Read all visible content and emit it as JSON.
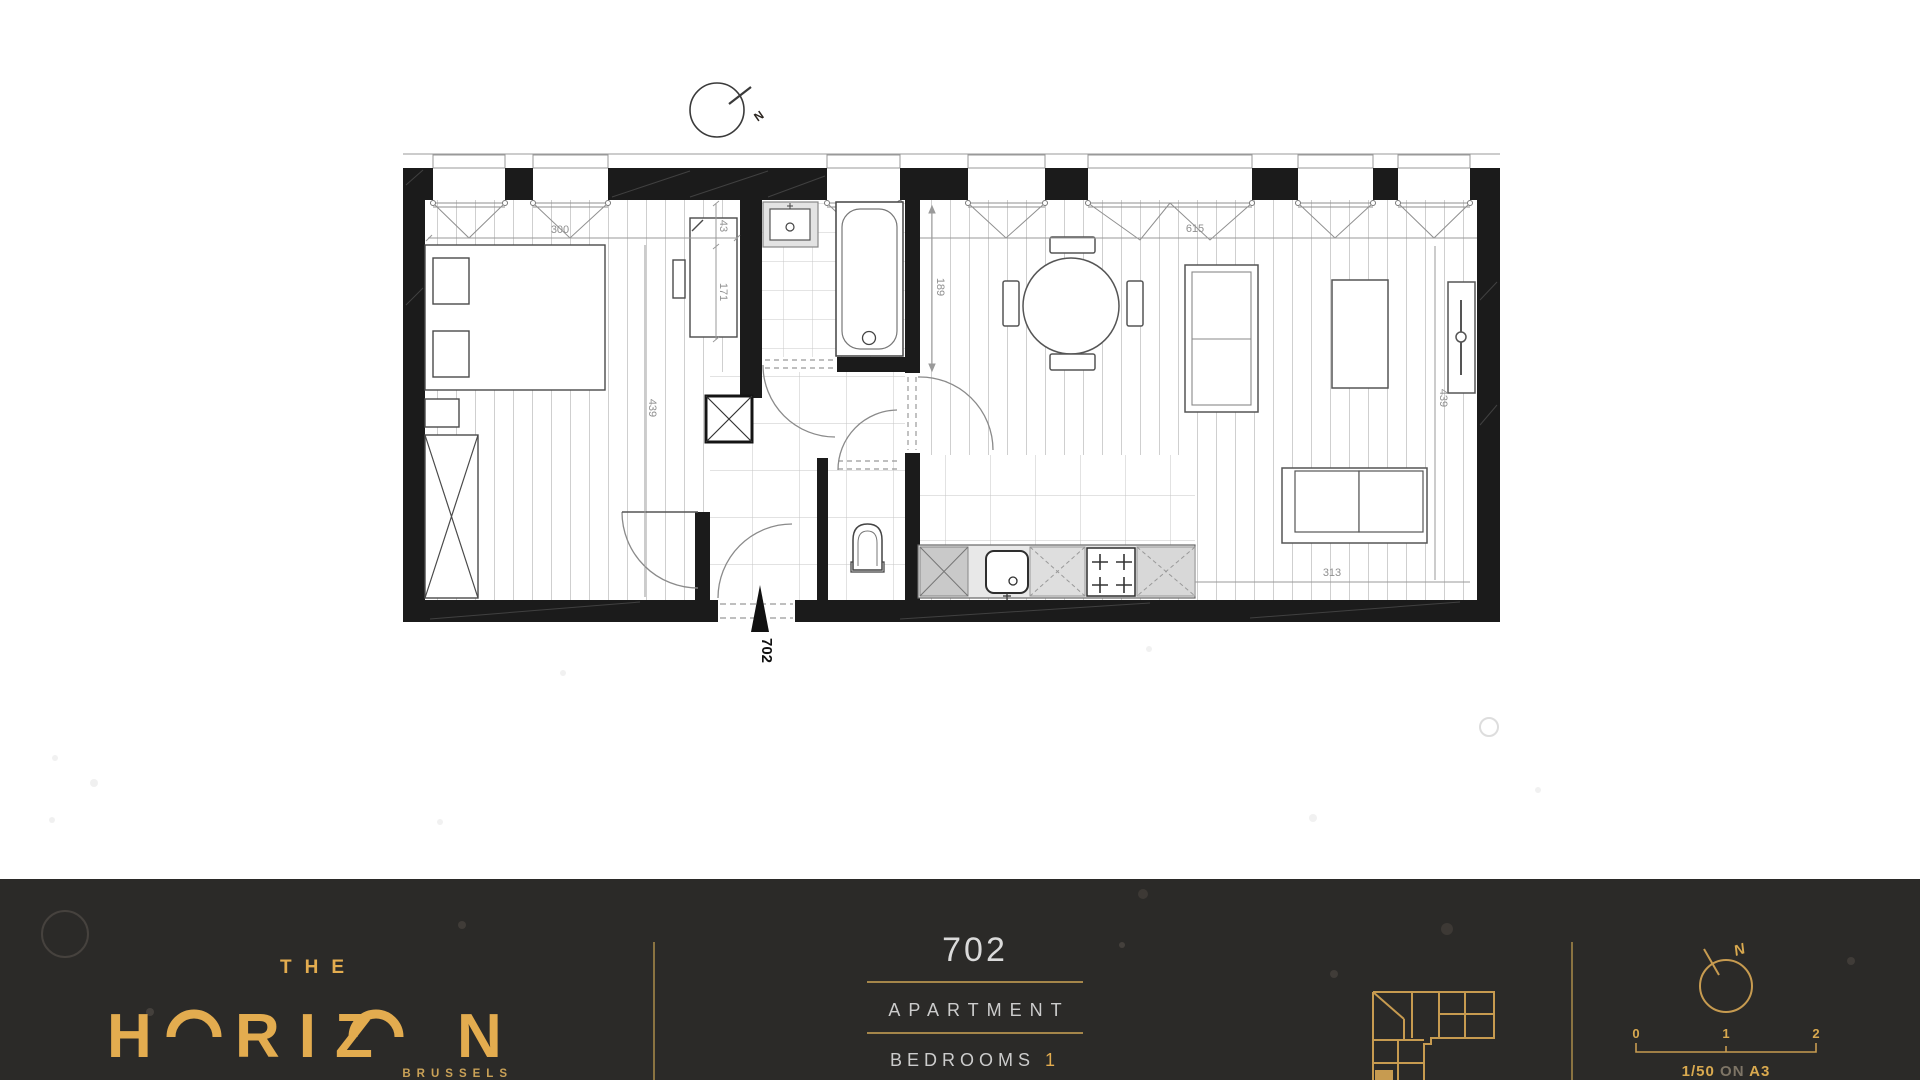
{
  "plan": {
    "north_label": "N",
    "entry_label": "702",
    "dims": {
      "bedroom_width": "300",
      "closet_a": "43",
      "closet_b": "171",
      "bedroom_depth": "439",
      "bath_depth": "189",
      "living_width": "615",
      "living_depth": "439",
      "kitchen_run": "313"
    }
  },
  "footer": {
    "brand": {
      "the": "THE",
      "part1": "H",
      "part2": "RIZ",
      "part3": "N",
      "city": "BRUSSELS"
    },
    "unit": {
      "number": "702",
      "type": "APARTMENT",
      "bedrooms_label": "BEDROOMS",
      "bedrooms_value": "1"
    },
    "scale": {
      "t0": "0",
      "t1": "1",
      "t2": "2",
      "ratio": "1/50",
      "conj": "ON",
      "paper": "A3",
      "north": "N"
    }
  },
  "colors": {
    "gold": "#E3AC4F",
    "gold_dim": "#8a7341",
    "footer_bg": "#2B2A28",
    "wall": "#1b1b1b"
  }
}
